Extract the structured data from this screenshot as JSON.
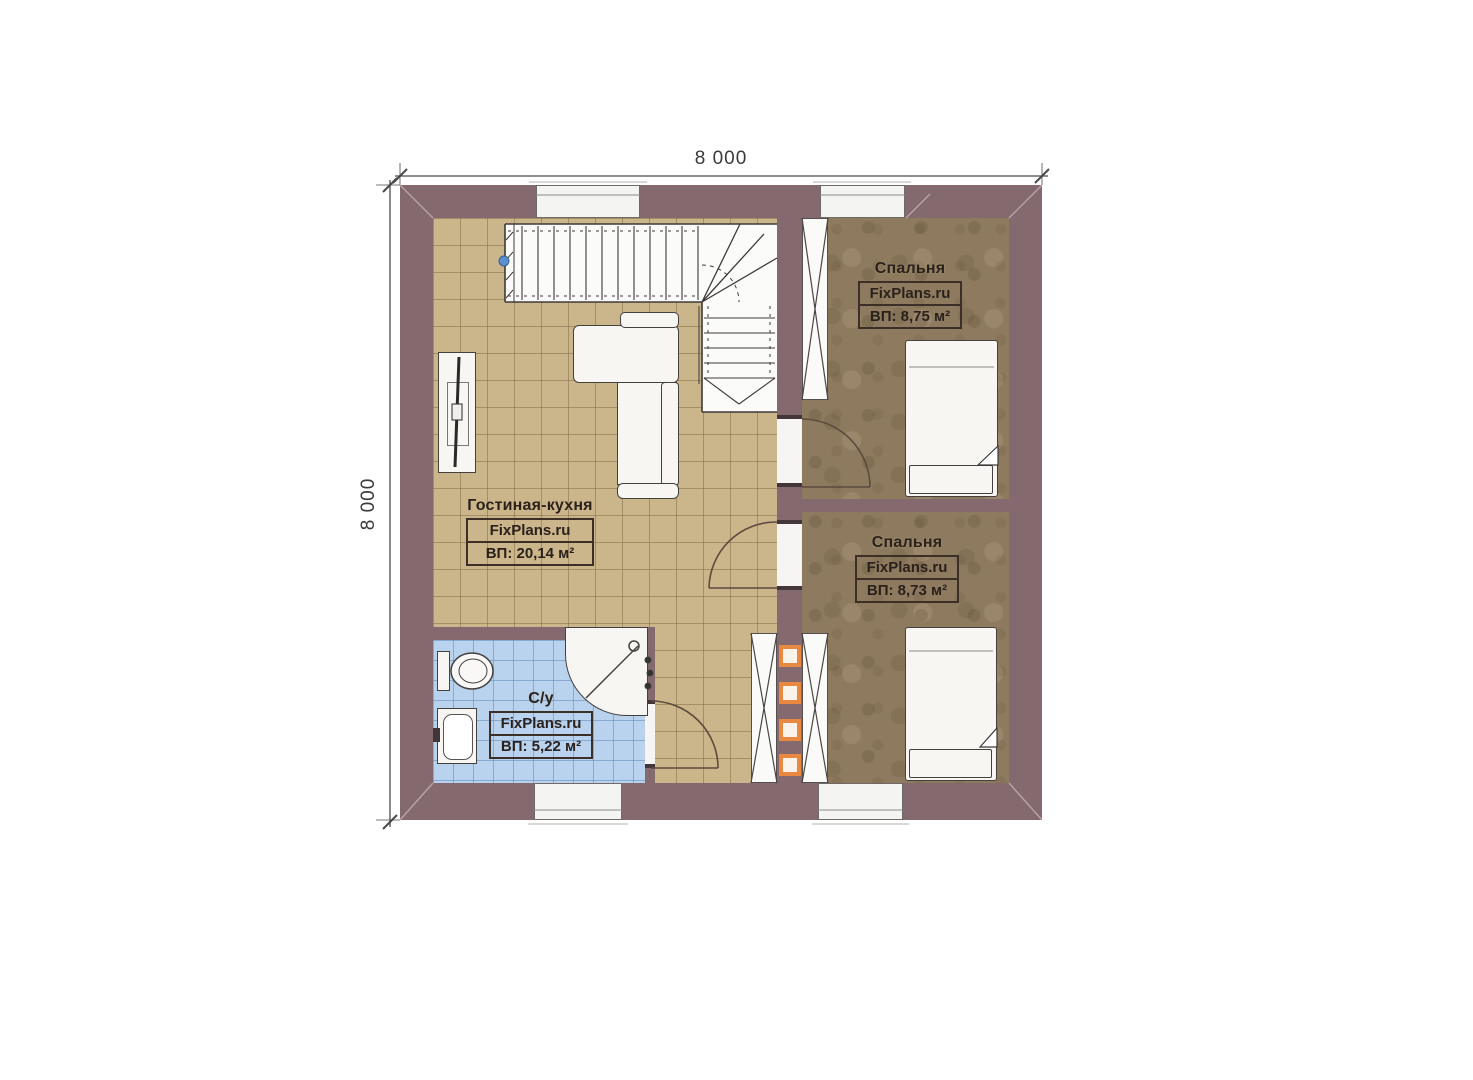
{
  "plan": {
    "type": "floor-plan",
    "dimension_top": "8 000",
    "dimension_left": "8 000"
  },
  "rooms": [
    {
      "name": "Гостиная-кухня",
      "brand": "FixPlans.ru",
      "area": "ВП: 20,14 м²"
    },
    {
      "name": "Спальня",
      "brand": "FixPlans.ru",
      "area": "ВП: 8,75 м²"
    },
    {
      "name": "Спальня",
      "brand": "FixPlans.ru",
      "area": "ВП: 8,73 м²"
    },
    {
      "name": "С/у",
      "brand": "FixPlans.ru",
      "area": "ВП: 5,22 м²"
    }
  ],
  "colors": {
    "wall": "#84696E",
    "floor_living": "#CBB58A",
    "floor_bedroom": "#8E7B5F",
    "floor_bathroom": "#B9D3EF",
    "vent_accent": "#E98840",
    "label_text": "#2B211C"
  }
}
